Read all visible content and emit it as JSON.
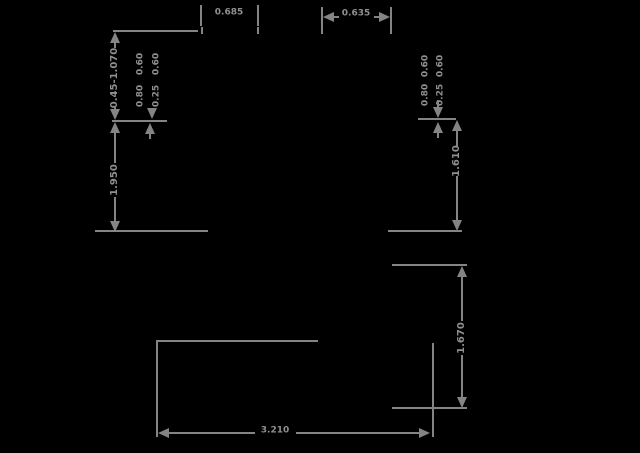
{
  "drawing": {
    "background": "#000000",
    "ink": "#848484",
    "labels": {
      "top_left_width": "0.685",
      "top_right_width": "0.635",
      "left_chain_upper": "0.45-1.070",
      "left_chain_lower": "1.950",
      "right_upper_height": "1.610",
      "right_lower_height": "1.670",
      "bottom_width": "3.210",
      "left_block": {
        "top": [
          "0.60",
          "0.60"
        ],
        "bottom": [
          "0.80",
          "0.25"
        ]
      },
      "right_block": {
        "top": [
          "0.60",
          "0.60"
        ],
        "bottom": [
          "0.80",
          "0.25"
        ]
      }
    }
  }
}
